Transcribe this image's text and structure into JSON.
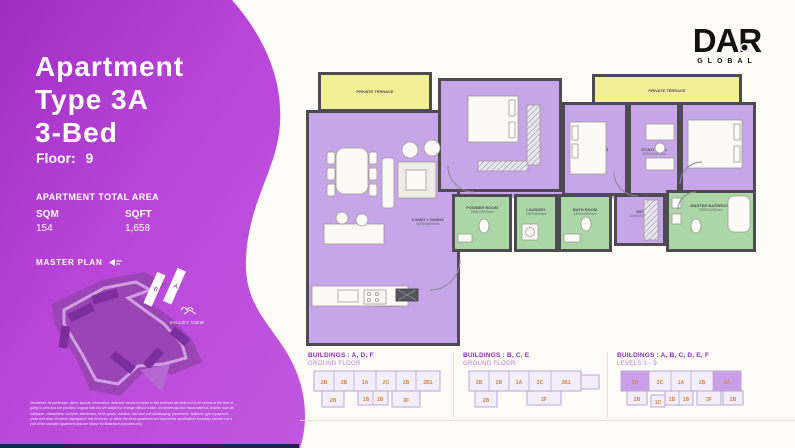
{
  "brand": {
    "name": "DAR",
    "sub": "GLOBAL"
  },
  "panel": {
    "title_line1": "Apartment",
    "title_line2": "Type 3A",
    "title_line3": "3-Bed",
    "floor_label": "Floor:",
    "floor_value": "9",
    "area_header": "APARTMENT TOTAL AREA",
    "sqm_label": "SQM",
    "sqm_value": "154",
    "sqft_label": "SQFT",
    "sqft_value": "1,658",
    "master_plan_label": "MASTER PLAN",
    "valley_view_label": "VALLEY VIEW",
    "building_a": "A",
    "building_b": "B",
    "disclaimer": "Disclaimer: All particulars, plans, layouts, information, data and visuals included in this brochure are believed to be correct at the time of going to print and are provided in good faith but are subject to change without notice. All renderings and visual material, finishes such as wallpaper, chandeliers, furniture, electronics, white goods, curtains, hard and soft landscaping, pavements, features, gym equipment, pools and other elements displayed in this brochure, or within the show apartment are beyond the specification boundary and are not a part of the standard apartment and are shown for illustrative purposes only."
  },
  "plan": {
    "terrace_label": "PRIVATE TERRACE",
    "rooms": {
      "living": {
        "name": "LIVING + DINING",
        "dims": "5600x5000mm"
      },
      "kitchen": {
        "name": "KITCHEN",
        "dims": "3000x2000mm"
      },
      "bedroom2": {
        "name": "BEDROOM 02",
        "dims": "3000x3200mm"
      },
      "bedroom3": {
        "name": "BEDROOM 03",
        "dims": "4000x3000mm"
      },
      "study": {
        "name": "STUDY AREA",
        "dims": "3000x2400mm"
      },
      "master": {
        "name": "MASTER BEDROOM",
        "dims": "3600x3600mm"
      },
      "powder": {
        "name": "POWDER ROOM",
        "dims": "1500x2000mm"
      },
      "laundry": {
        "name": "LAUNDRY",
        "dims": "1350x800mm"
      },
      "bathroom": {
        "name": "BATH ROOM",
        "dims": "2400x1550mm"
      },
      "wic": {
        "name": "WIC",
        "dims": "1100x1900mm"
      },
      "master_bath": {
        "name": "MASTER BATHROOM",
        "dims": "2000x2400mm"
      }
    }
  },
  "diagrams": [
    {
      "title": "BUILDINGS : A, D, F",
      "subtitle": "GROUND FLOOR",
      "units_top": [
        "2B",
        "2B",
        "1A",
        "2C",
        "2B",
        "2B1"
      ],
      "units_bottom": [
        "2B",
        "1B",
        "1B",
        "2F"
      ]
    },
    {
      "title": "BUILDINGS : B, C, E",
      "subtitle": "GROUND FLOOR",
      "units_top": [
        "2B",
        "2B",
        "1A",
        "2C",
        "2B1"
      ],
      "units_bottom": [
        "2B",
        "2F"
      ]
    },
    {
      "title": "BUILDINGS : A, B, C, D, E, F",
      "subtitle": "LEVELS 1 - 9",
      "units_top": [
        "3A",
        "2C",
        "1A",
        "2B",
        "3A"
      ],
      "units_bottom": [
        "2B",
        "1C",
        "1B",
        "1B",
        "2F",
        "2B"
      ]
    }
  ],
  "colors": {
    "panel_purple": "#b948da",
    "floor_purple": "#c7a5e9",
    "wall_gray": "#4d4a52",
    "terrace_yellow": "#f2ef96",
    "wet_green": "#abd7a6",
    "unit_orange": "#d4823e",
    "diagram_purple": "#8a2dbb",
    "footer_navy": "#222150"
  }
}
